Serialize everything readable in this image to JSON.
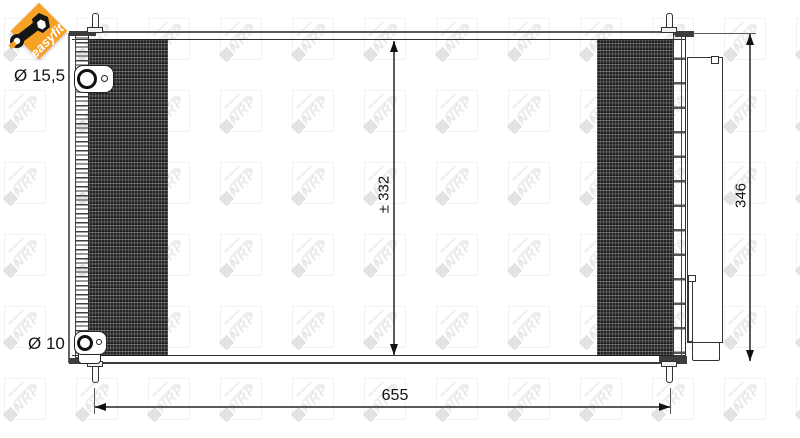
{
  "badge": {
    "label": "easyfit",
    "color": "#F7A227",
    "icon": "key-icon"
  },
  "watermark": {
    "text": "NRF"
  },
  "annotations": {
    "top_fitting_diameter": "Ø 15,5",
    "bottom_fitting_diameter": "Ø 10"
  },
  "dimensions": {
    "core_height": "± 332",
    "overall_height": "346",
    "overall_width": "655"
  },
  "colors": {
    "line": "#2f2f2f",
    "dimension_line": "#5a5a5a",
    "accent_orange": "#F7A227",
    "watermark_gray": "#ebe9e9"
  }
}
